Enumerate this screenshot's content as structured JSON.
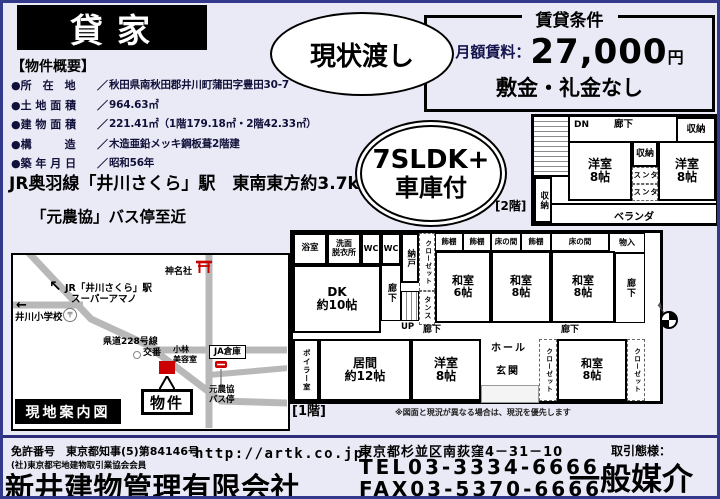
{
  "colors": {
    "accent_red": "#cc0000",
    "page_bg": "#eaeaf6",
    "frame_navy": "#333a8c"
  },
  "header": {
    "title_badge": "貸家",
    "condition_badge": "現状渡し",
    "layout_badge_line1": "7SLDK+",
    "layout_badge_line2": "車庫付"
  },
  "rental_terms": {
    "title": "賃貸条件",
    "rent_label": "月額賃料：",
    "rent_value": "27,000",
    "rent_unit": "円",
    "deposit_note": "敷金・礼金なし"
  },
  "overview": {
    "heading": "【物件概要】",
    "rows": [
      {
        "label": "●所　在　地",
        "sep": "／",
        "value": "秋田県南秋田郡井川町蒲田字豊田30-7"
      },
      {
        "label": "●土 地 面 積",
        "sep": "／",
        "value": "964.63㎡"
      },
      {
        "label": "●建 物 面 積",
        "sep": "／",
        "value": "221.41㎡（1階179.18㎡・2階42.33㎡）"
      },
      {
        "label": "●構　　　造",
        "sep": "／",
        "value": "木造亜鉛メッキ鋼板葺2階建"
      },
      {
        "label": "●築 年 月 日",
        "sep": "／",
        "value": "昭和56年"
      }
    ],
    "access_train": "JR奥羽線「井川さくら」駅　東南東方約3.7km",
    "access_bus": "「元農協」バス停至近"
  },
  "map": {
    "caption": "現地案内図",
    "arrow_nw": "↖",
    "station_line1": "JR「井川さくら」駅",
    "station_line2": "スーパーアマノ",
    "post_mark": "〒",
    "arrow_w": "←",
    "school": "井川小学校",
    "shrine": "神名社",
    "road228": "県道228号線",
    "police": "交番",
    "salon": "小林\n美容室",
    "ja_warehouse": "JA倉庫",
    "property_box": "物件",
    "bus_stop": "元農協\nバス停"
  },
  "floor2": {
    "label": "[2階]",
    "rooms": {
      "dn": "DN",
      "hall": "廊下",
      "closet_tr": "収納",
      "yoshitsu_w": "洋室\n8帖",
      "closet_mid": "収納",
      "tansu1": "タンス",
      "tansu2": "タンス",
      "yoshitsu_e": "洋室\n8帖",
      "closet_bl": "収納",
      "veranda": "ベランダ"
    }
  },
  "floor1": {
    "label": "[1階]",
    "note": "※図面と現況が異なる場合は、現況を優先します",
    "rooms": {
      "bath": "浴室",
      "washroom": "洗面\n脱衣所",
      "wc1": "WC",
      "wc2": "WC",
      "nando": "納戸",
      "closet_n": "クローゼット",
      "dk": "DK\n約10帖",
      "hall_v": "廊下",
      "up": "UP",
      "tansu": "タンス",
      "shelf1": "飾棚",
      "shelf2": "飾棚",
      "tokonoma1": "床の間",
      "shelf3": "飾棚",
      "tokonoma2": "床の間",
      "monoire": "物入",
      "washitsu6": "和室\n6帖",
      "washitsu8a": "和室\n8帖",
      "washitsu8b": "和室\n8帖",
      "hall_e": "廊下",
      "hall_s1": "廊下",
      "hall_s2": "廊下",
      "boiler": "ボイラー室",
      "living": "居間\n約12帖",
      "yoshitsu": "洋室\n8帖",
      "hall": "ホール",
      "genkan": "玄関",
      "closet_w": "クローゼット",
      "washitsu8c": "和室\n8帖",
      "closet_e": "クローゼット"
    }
  },
  "footer": {
    "license_label": "免許番号",
    "license": "東京都知事(5)第84146号",
    "association": "(社)東京都宅地建物取引業協会会員",
    "company": "新井建物管理有限会社",
    "url": "http://artk.co.jp/",
    "address": "東京都杉並区南荻窪4－31－10",
    "tel": "TEL03-3334-6666",
    "fax": "FAX03-5370-6666",
    "transaction_label": "取引態様：",
    "transaction_type": "一般媒介"
  }
}
